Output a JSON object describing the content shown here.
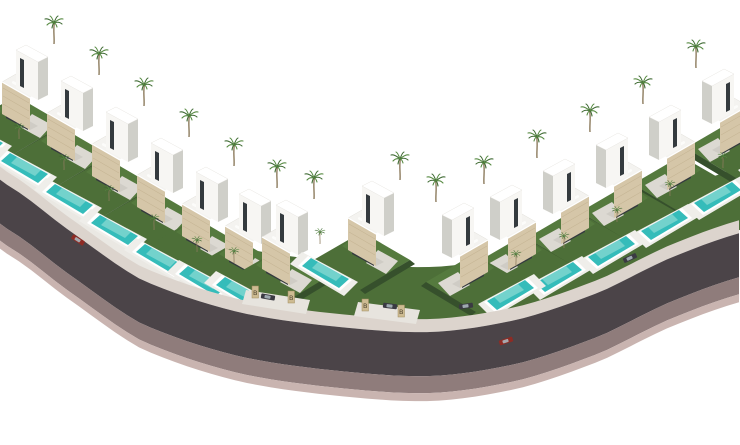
{
  "scene": {
    "description": "Aerial 3D architectural rendering of a modern villa development: two staggered rows of white villas with beige stone facade panels, rooftop terraces with sun loungers, private turquoise swimming pools and palm trees, arranged along a dark curved road with a mauve embankment, on a pure white background.",
    "background_color": "#ffffff",
    "left_row_villas": 8,
    "right_row_villas": 6,
    "total_villas": 14,
    "pools_per_villa": 1,
    "palm_trees": 28
  },
  "signpost": {
    "label": "B"
  },
  "road": {
    "curb_color": "#dcd4cd",
    "asphalt_color": "#4b4448",
    "embankment_color": "#8f7c7b",
    "embankment_edge_color": "#c9b4b0",
    "promenade_color": "#eae8e3",
    "parking_bay_color": "#e7e4de"
  },
  "villa": {
    "wall_color": "#f7f6f3",
    "wall_shade_color": "#cfcfc9",
    "roof_color": "#ffffff",
    "stone_panel_color": "#d5c6a8",
    "stone_panel_line_color": "#c2b190",
    "terrace_color": "#f4f3f0",
    "terrace_edge_color": "#e2e0da",
    "lounger_color": "#fcfcfa",
    "window_color": "#343a3e",
    "window_glass_color": "#6c7f86",
    "shadow_color": "#000000"
  },
  "landscape": {
    "lawn_color": "#4d6f38",
    "lawn_light_color": "#5d8444",
    "hedge_color": "#36502c",
    "deck_color": "#efeeea",
    "pool_rim_color": "#ffffff",
    "pool_color": "#35bcba",
    "pool_ripple_color": "#8fdcd4",
    "path_color": "#dcd9d2",
    "palm_trunk_color": "#8d7c5e",
    "palm_frond_color": "#3f6a33",
    "palm_frond_light_color": "#578a42"
  },
  "vehicles": {
    "count": 6,
    "dark_color": "#3a3a42",
    "red_color": "#8e2b24",
    "glass_color": "#aab6bd"
  },
  "signpost_style": {
    "post_color": "#cdbb92",
    "post_border_color": "#a08c5e",
    "label_color": "#4f4430"
  }
}
